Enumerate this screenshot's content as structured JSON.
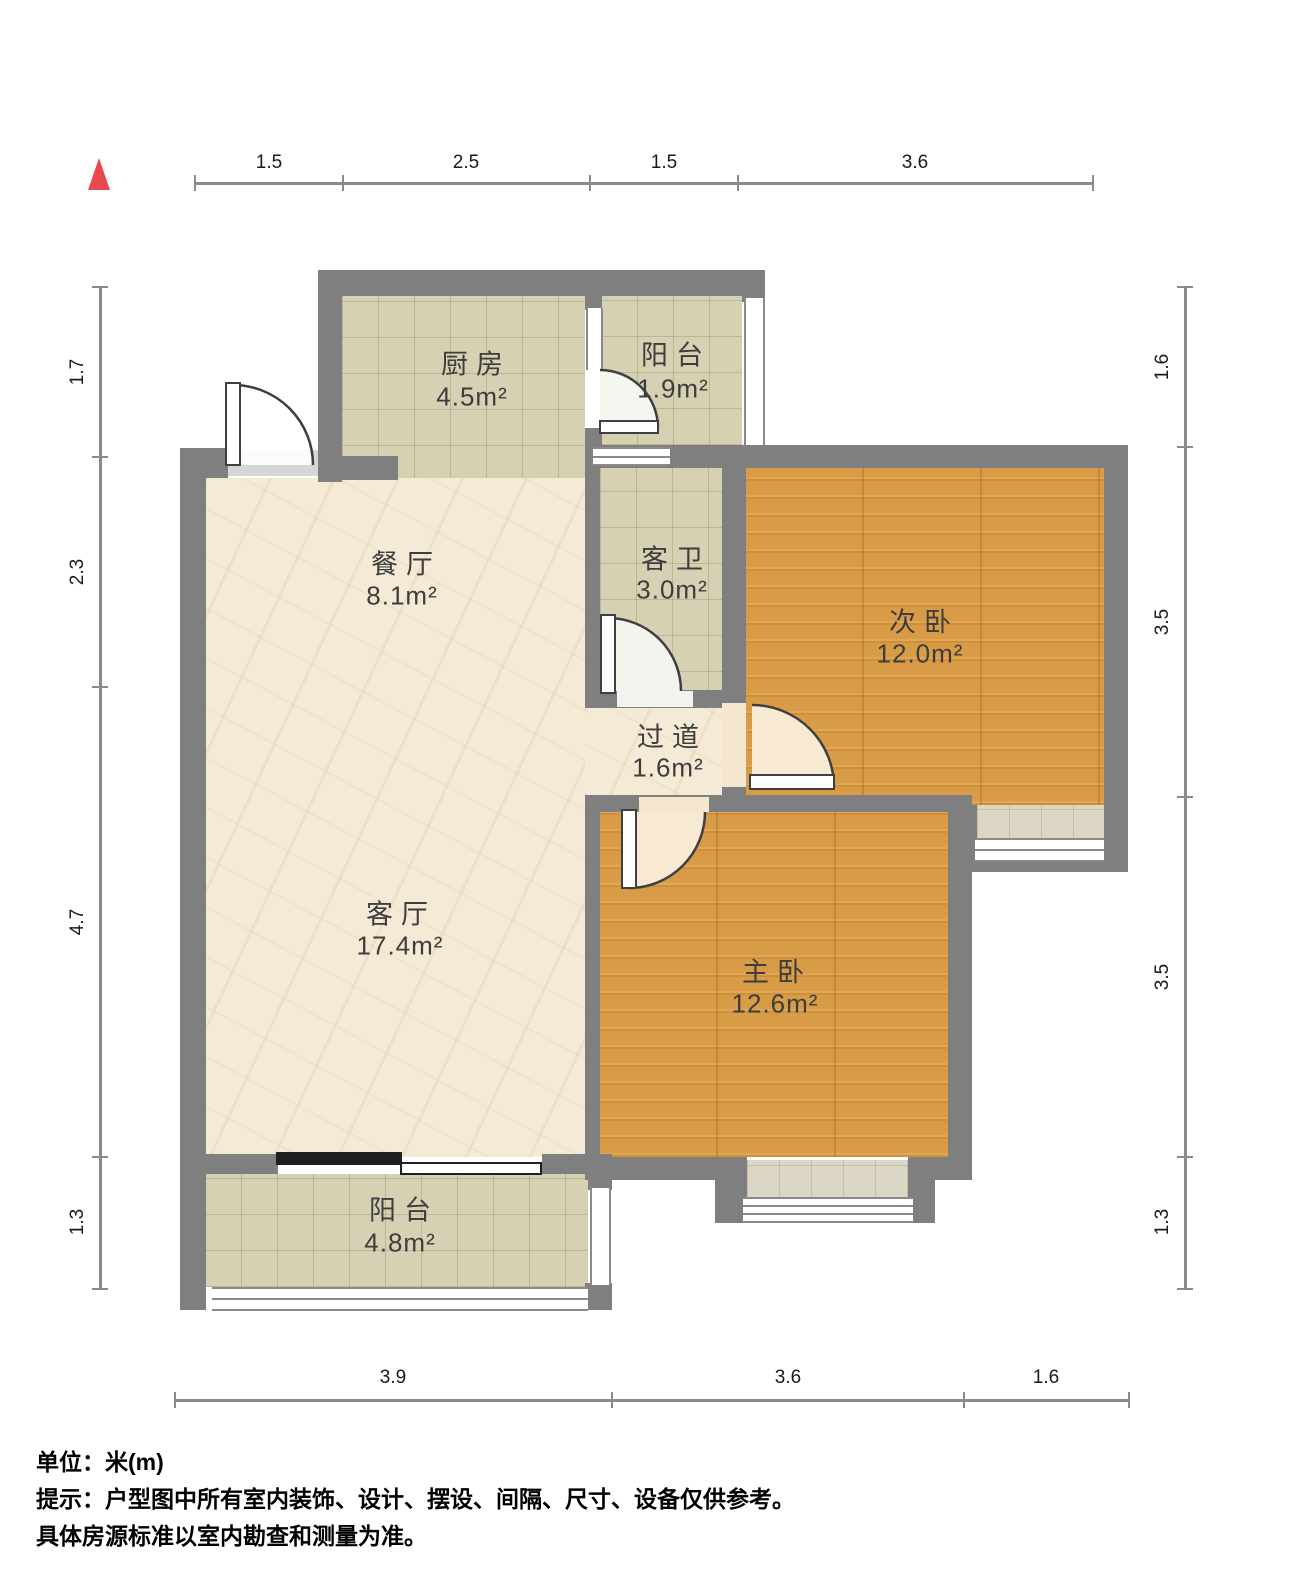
{
  "north_arrow": {
    "color": "#e8484e"
  },
  "rooms": {
    "kitchen": {
      "name": "厨房",
      "area": "4.5m²"
    },
    "balcony_top": {
      "name": "阳台",
      "area": "1.9m²"
    },
    "dining": {
      "name": "餐厅",
      "area": "8.1m²"
    },
    "bathroom": {
      "name": "客卫",
      "area": "3.0m²"
    },
    "bedroom2": {
      "name": "次卧",
      "area": "12.0m²"
    },
    "hallway": {
      "name": "过道",
      "area": "1.6m²"
    },
    "living": {
      "name": "客厅",
      "area": "17.4m²"
    },
    "master": {
      "name": "主卧",
      "area": "12.6m²"
    },
    "balcony_bottom": {
      "name": "阳台",
      "area": "4.8m²"
    }
  },
  "dimensions": {
    "top": [
      "1.5",
      "2.5",
      "1.5",
      "3.6"
    ],
    "left": [
      "1.7",
      "2.3",
      "4.7",
      "1.3"
    ],
    "right": [
      "1.6",
      "3.5",
      "3.5",
      "1.3"
    ],
    "bottom": [
      "3.9",
      "3.6",
      "1.6"
    ]
  },
  "notes": [
    "单位：米(m)",
    "提示：户型图中所有室内装饰、设计、摆设、间隔、尺寸、设备仅供参考。",
    "具体房源标准以室内勘查和测量为准。"
  ],
  "colors": {
    "wall": "#7f7f7f",
    "wood_floor": "#d99c46",
    "tile_floor": "#d7d1b4",
    "marble_floor": "#f4ead6",
    "window": "#ffffff",
    "north_arrow": "#e8484e"
  }
}
